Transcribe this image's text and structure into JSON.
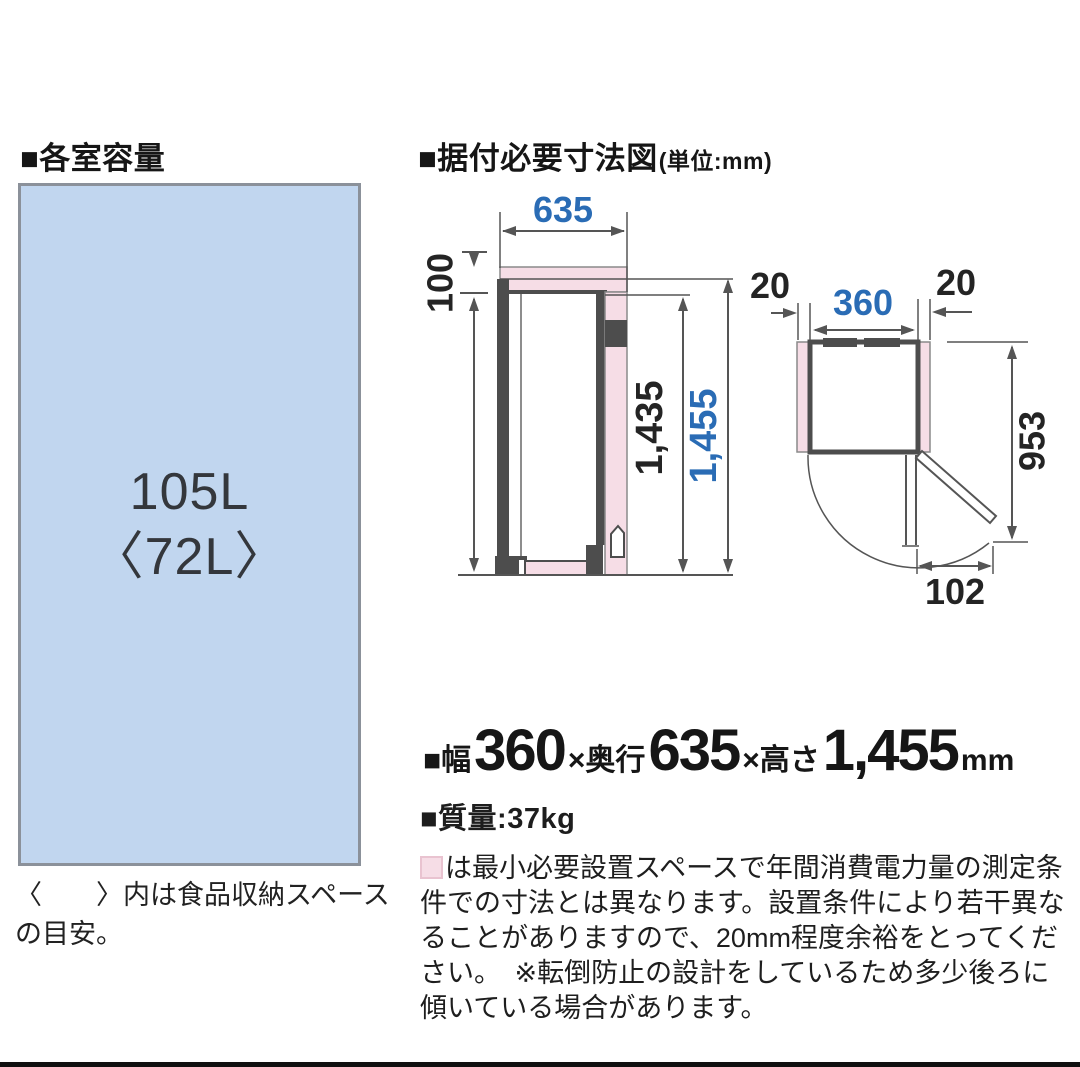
{
  "colors": {
    "dim_blue": "#2a6cb5",
    "pink": "#f6dde6",
    "dark": "#4d4d4d",
    "line": "#555555",
    "box_fill": "#c1d6ef",
    "box_border": "#8b919a",
    "text": "#1b1b1b",
    "bottom_bar": "#101010"
  },
  "left_section": {
    "heading": "■各室容量",
    "capacity_main": "105L",
    "capacity_sub": "〈72L〉",
    "caption": "〈　　〉内は食品収納スペースの目安。"
  },
  "right_section": {
    "heading": "■据付必要寸法図",
    "heading_unit": "(単位:mm)"
  },
  "diagram": {
    "side_view": {
      "depth": "635",
      "top_clearance": "100",
      "body_height": "1,435",
      "total_height": "1,455"
    },
    "top_view": {
      "left_clearance": "20",
      "width": "360",
      "right_clearance": "20",
      "swing_depth": "953",
      "door_offset": "102"
    }
  },
  "specs": {
    "width_prefix": "■幅",
    "width": "360",
    "depth_prefix": "×奥行",
    "depth": "635",
    "height_prefix": "×高さ",
    "height": "1,455",
    "unit": "mm",
    "mass_label": "■質量:",
    "mass": "37kg"
  },
  "footnote": {
    "text": "は最小必要設置スペースで年間消費電力量の測定条件での寸法とは異なります。設置条件により若干異なることがありますので、20mm程度余裕をとってください。　※転倒防止の設計をしているため多少後ろに傾いている場合があります。"
  }
}
